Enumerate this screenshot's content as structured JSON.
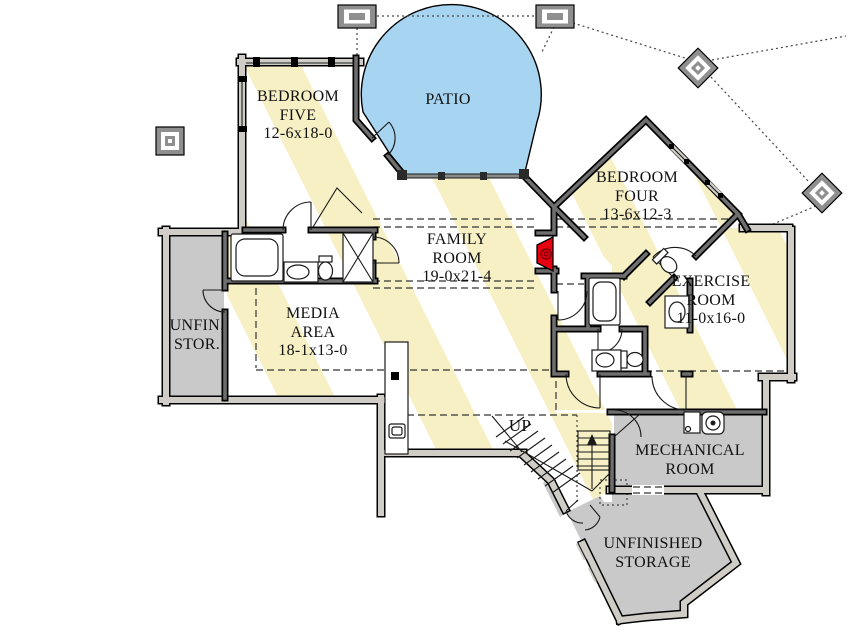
{
  "plan_type": "basement floor plan",
  "labels": {
    "bedroom_five": {
      "line1": "BEDROOM",
      "line2": "FIVE",
      "dims": "12-6x18-0"
    },
    "patio": {
      "line1": "PATIO"
    },
    "bedroom_four": {
      "line1": "BEDROOM",
      "line2": "FOUR",
      "dims": "13-6x12-3"
    },
    "family_room": {
      "line1": "FAMILY",
      "line2": "ROOM",
      "dims": "19-0x21-4"
    },
    "media_area": {
      "line1": "MEDIA",
      "line2": "AREA",
      "dims": "18-1x13-0"
    },
    "exercise_room": {
      "line1": "EXERCISE",
      "line2": "ROOM",
      "dims": "11-0x16-0"
    },
    "unfin_stor": {
      "line1": "UNFIN.",
      "line2": "STOR."
    },
    "mechanical_room": {
      "line1": "MECHANICAL",
      "line2": "ROOM"
    },
    "unfinished_storage": {
      "line1": "UNFINISHED",
      "line2": "STORAGE"
    },
    "stairs": {
      "up": "UP"
    }
  },
  "colors": {
    "stripe_yellow": "#F7F0C5",
    "patio_blue": "#A7D4F0",
    "storage_gray": "#C9C9C9",
    "fireplace_red": "#E60012",
    "wall_interior": "#6E6E6E",
    "wall_exterior": "#CFCDC6",
    "outline": "#000000"
  },
  "icons": [
    "bathtub-icon",
    "toilet-icon",
    "sink-icon",
    "shower-icon",
    "fireplace-icon",
    "water-heater-icon",
    "furnace-icon",
    "bar-sink-icon",
    "column-icon",
    "stairs-up-arrow-icon"
  ]
}
